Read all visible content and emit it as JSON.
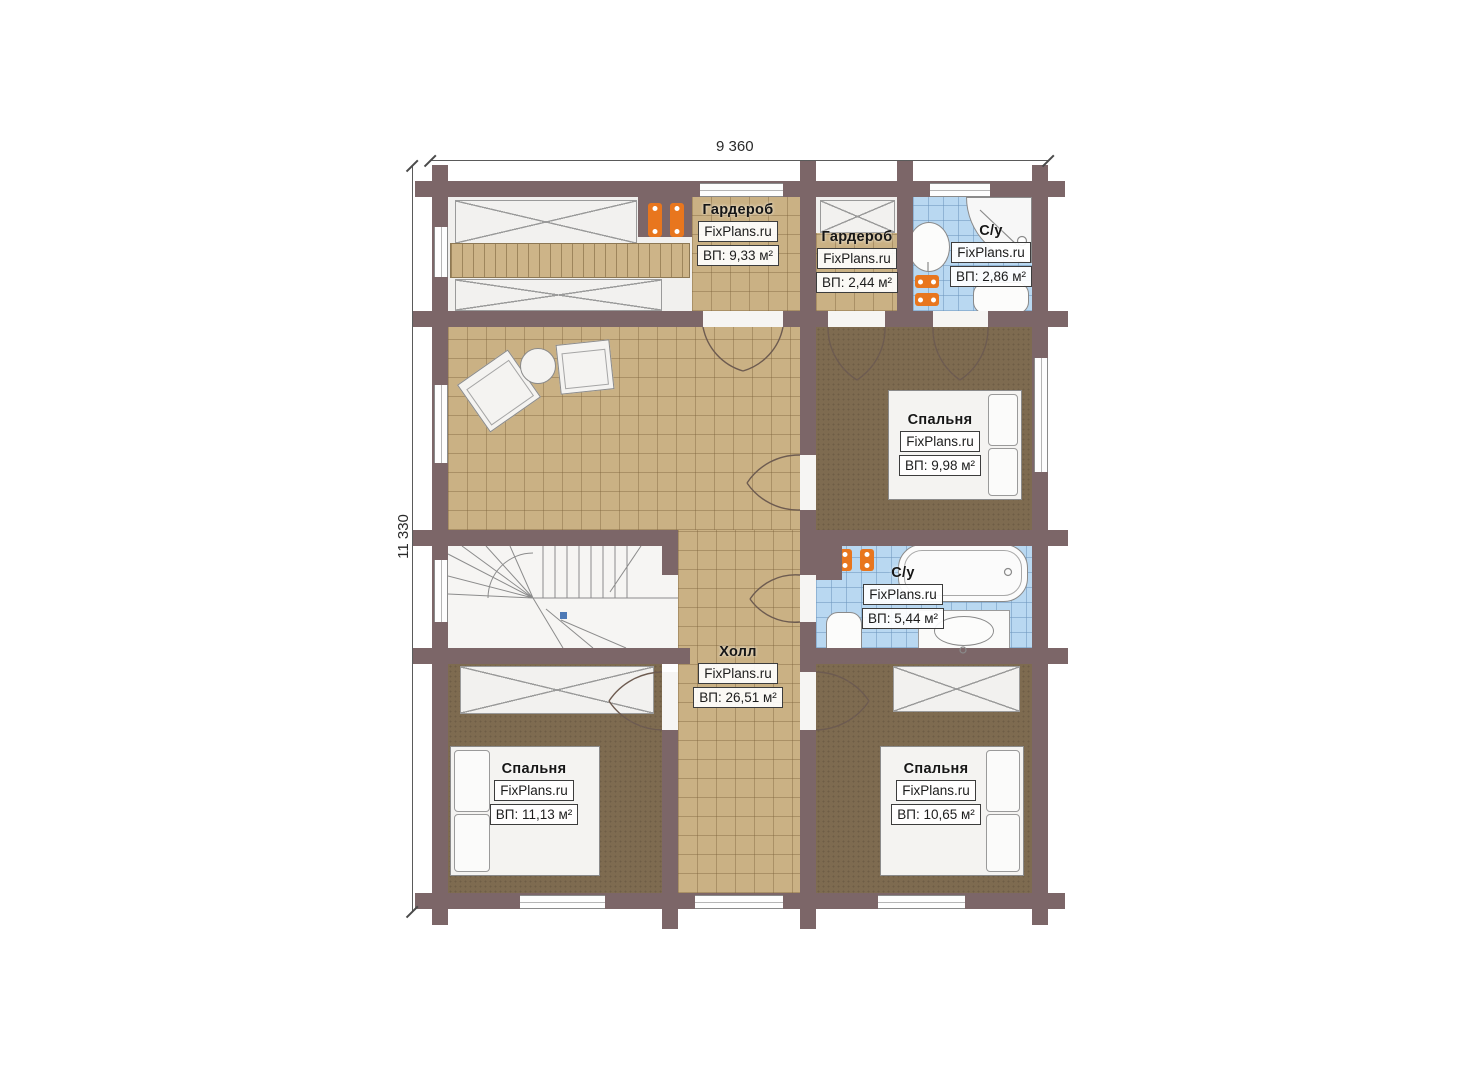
{
  "plan": {
    "dim_width": "9 360",
    "dim_height": "11 330"
  },
  "rooms": [
    {
      "name": "Гардероб",
      "brand": "FixPlans.ru",
      "area": "ВП: 9,33 м²"
    },
    {
      "name": "Гардероб",
      "brand": "FixPlans.ru",
      "area": "ВП: 2,44 м²"
    },
    {
      "name": "С/у",
      "brand": "FixPlans.ru",
      "area": "ВП: 2,86 м²"
    },
    {
      "name": "Спальня",
      "brand": "FixPlans.ru",
      "area": "ВП: 9,98 м²"
    },
    {
      "name": "С/у",
      "brand": "FixPlans.ru",
      "area": "ВП: 5,44 м²"
    },
    {
      "name": "Холл",
      "brand": "FixPlans.ru",
      "area": "ВП: 26,51 м²"
    },
    {
      "name": "Спальня",
      "brand": "FixPlans.ru",
      "area": "ВП: 11,13 м²"
    },
    {
      "name": "Спальня",
      "brand": "FixPlans.ru",
      "area": "ВП: 10,65 м²"
    }
  ],
  "colors": {
    "wall": "#7c6668",
    "floor_tile_tan": "#cab184",
    "floor_bedroom": "#7e6b50",
    "bath_tile_blue": "#b9d8f1",
    "radiator_orange": "#e8761e",
    "stair_marker_blue": "#4d79b5"
  }
}
